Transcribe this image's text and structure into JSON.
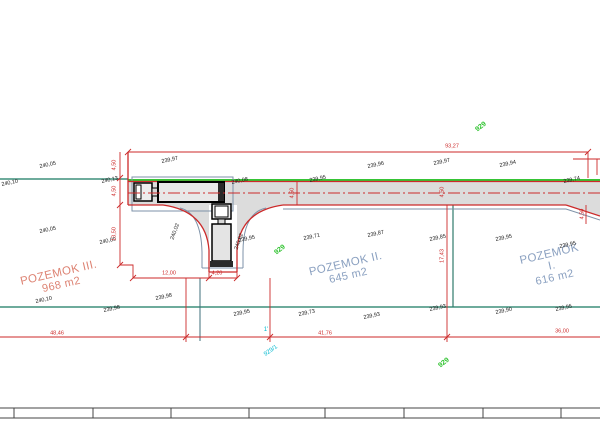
{
  "parcels": [
    {
      "name": "POZEMOK III.",
      "area": "968 m2"
    },
    {
      "name": "POZEMOK II.",
      "area": "645 m2"
    },
    {
      "name": "POZEMOK I.",
      "area": "616 m2"
    }
  ],
  "colors": {
    "dimension_red": "#cc2a2a",
    "boundary_teal": "#3f8f7b",
    "road_edge_green": "#35c435",
    "cadastre_cyan": "#00b9cf",
    "parcel_text_blue": "#8aa0c0",
    "parcel_text_red": "#dd8272",
    "road_fill": "#dcdcdc"
  },
  "annotations": {
    "elevations": [
      {
        "text": "240,10",
        "x": 10,
        "y": 184,
        "rot": -12
      },
      {
        "text": "240,05",
        "x": 48,
        "y": 166,
        "rot": -12
      },
      {
        "text": "240,13",
        "x": 110,
        "y": 181,
        "rot": -12
      },
      {
        "text": "239,97",
        "x": 170,
        "y": 161,
        "rot": -12
      },
      {
        "text": "240,08",
        "x": 240,
        "y": 182,
        "rot": -12
      },
      {
        "text": "239,95",
        "x": 318,
        "y": 180,
        "rot": -12
      },
      {
        "text": "239,96",
        "x": 376,
        "y": 166,
        "rot": -12
      },
      {
        "text": "239,97",
        "x": 442,
        "y": 163,
        "rot": -12
      },
      {
        "text": "239,94",
        "x": 508,
        "y": 165,
        "rot": -12
      },
      {
        "text": "239,74",
        "x": 572,
        "y": 181,
        "rot": -12
      },
      {
        "text": "240,05",
        "x": 48,
        "y": 231,
        "rot": -12
      },
      {
        "text": "240,09",
        "x": 108,
        "y": 242,
        "rot": -12
      },
      {
        "text": "239,95",
        "x": 247,
        "y": 240,
        "rot": -12
      },
      {
        "text": "239,71",
        "x": 312,
        "y": 238,
        "rot": -12
      },
      {
        "text": "239,87",
        "x": 376,
        "y": 235,
        "rot": -12
      },
      {
        "text": "239,85",
        "x": 438,
        "y": 239,
        "rot": -12
      },
      {
        "text": "239,95",
        "x": 504,
        "y": 239,
        "rot": -12
      },
      {
        "text": "239,95",
        "x": 568,
        "y": 246,
        "rot": -12
      },
      {
        "text": "240,10",
        "x": 44,
        "y": 301,
        "rot": -12
      },
      {
        "text": "239,98",
        "x": 112,
        "y": 310,
        "rot": -12
      },
      {
        "text": "239,98",
        "x": 164,
        "y": 298,
        "rot": -12
      },
      {
        "text": "239,95",
        "x": 242,
        "y": 314,
        "rot": -12
      },
      {
        "text": "239,73",
        "x": 307,
        "y": 314,
        "rot": -12
      },
      {
        "text": "239,93",
        "x": 372,
        "y": 317,
        "rot": -12
      },
      {
        "text": "239,93",
        "x": 438,
        "y": 309,
        "rot": -12
      },
      {
        "text": "239,90",
        "x": 504,
        "y": 312,
        "rot": -12
      },
      {
        "text": "239,95",
        "x": 564,
        "y": 309,
        "rot": -12
      },
      {
        "text": "240,02",
        "x": 176,
        "y": 232,
        "rot": -70
      },
      {
        "text": "240,02",
        "x": 240,
        "y": 242,
        "rot": -70
      }
    ],
    "red_dimensions": [
      {
        "text": "93,27",
        "x": 452,
        "y": 147,
        "rot": 0
      },
      {
        "text": "4,50",
        "x": 115,
        "y": 165,
        "rot": -90
      },
      {
        "text": "4,50",
        "x": 115,
        "y": 191,
        "rot": -90
      },
      {
        "text": "13,50",
        "x": 115,
        "y": 234,
        "rot": -90
      },
      {
        "text": "12,00",
        "x": 169,
        "y": 274,
        "rot": 0
      },
      {
        "text": "4,20",
        "x": 217,
        "y": 274,
        "rot": 0
      },
      {
        "text": "4,50",
        "x": 293,
        "y": 193,
        "rot": -90
      },
      {
        "text": "4,50",
        "x": 443,
        "y": 192,
        "rot": -90
      },
      {
        "text": "17,43",
        "x": 443,
        "y": 256,
        "rot": -90
      },
      {
        "text": "4,50",
        "x": 583,
        "y": 214,
        "rot": -90
      },
      {
        "text": "48,46",
        "x": 57,
        "y": 334,
        "rot": 0
      },
      {
        "text": "41,76",
        "x": 325,
        "y": 334,
        "rot": 0
      },
      {
        "text": "36,00",
        "x": 562,
        "y": 332,
        "rot": 0
      }
    ],
    "green_parcel_numbers": [
      {
        "text": "929",
        "x": 481,
        "y": 127,
        "rot": -38
      },
      {
        "text": "929",
        "x": 280,
        "y": 250,
        "rot": -38
      },
      {
        "text": "929",
        "x": 444,
        "y": 363,
        "rot": -38
      }
    ],
    "cyan_labels": [
      {
        "text": "1'",
        "x": 266,
        "y": 330,
        "rot": 0
      },
      {
        "text": "929/1",
        "x": 271,
        "y": 351,
        "rot": -35
      }
    ]
  }
}
